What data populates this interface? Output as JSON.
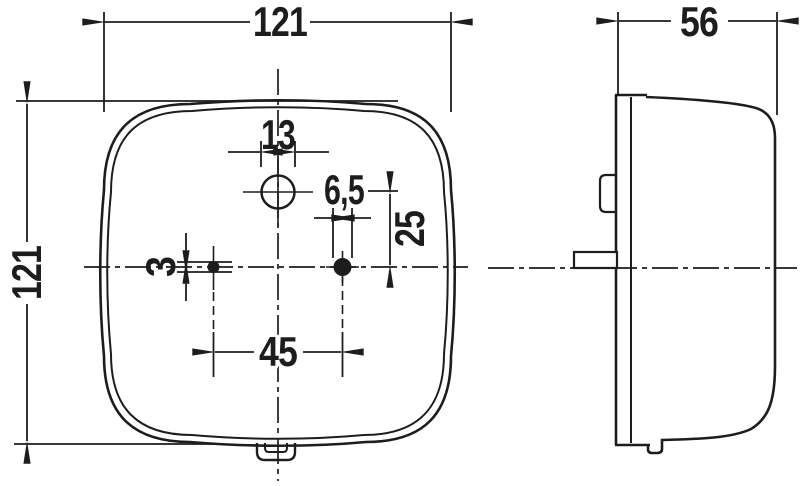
{
  "dims": {
    "front_width": "121",
    "front_height": "121",
    "top_hole_diameter": "13",
    "mount_hole_diameter": "6,5",
    "vertical_offset": "25",
    "pin_hole_diameter": "3",
    "hole_spacing": "45",
    "depth": "56"
  },
  "colors": {
    "line": "#1d1d1d",
    "background": "#ffffff"
  }
}
